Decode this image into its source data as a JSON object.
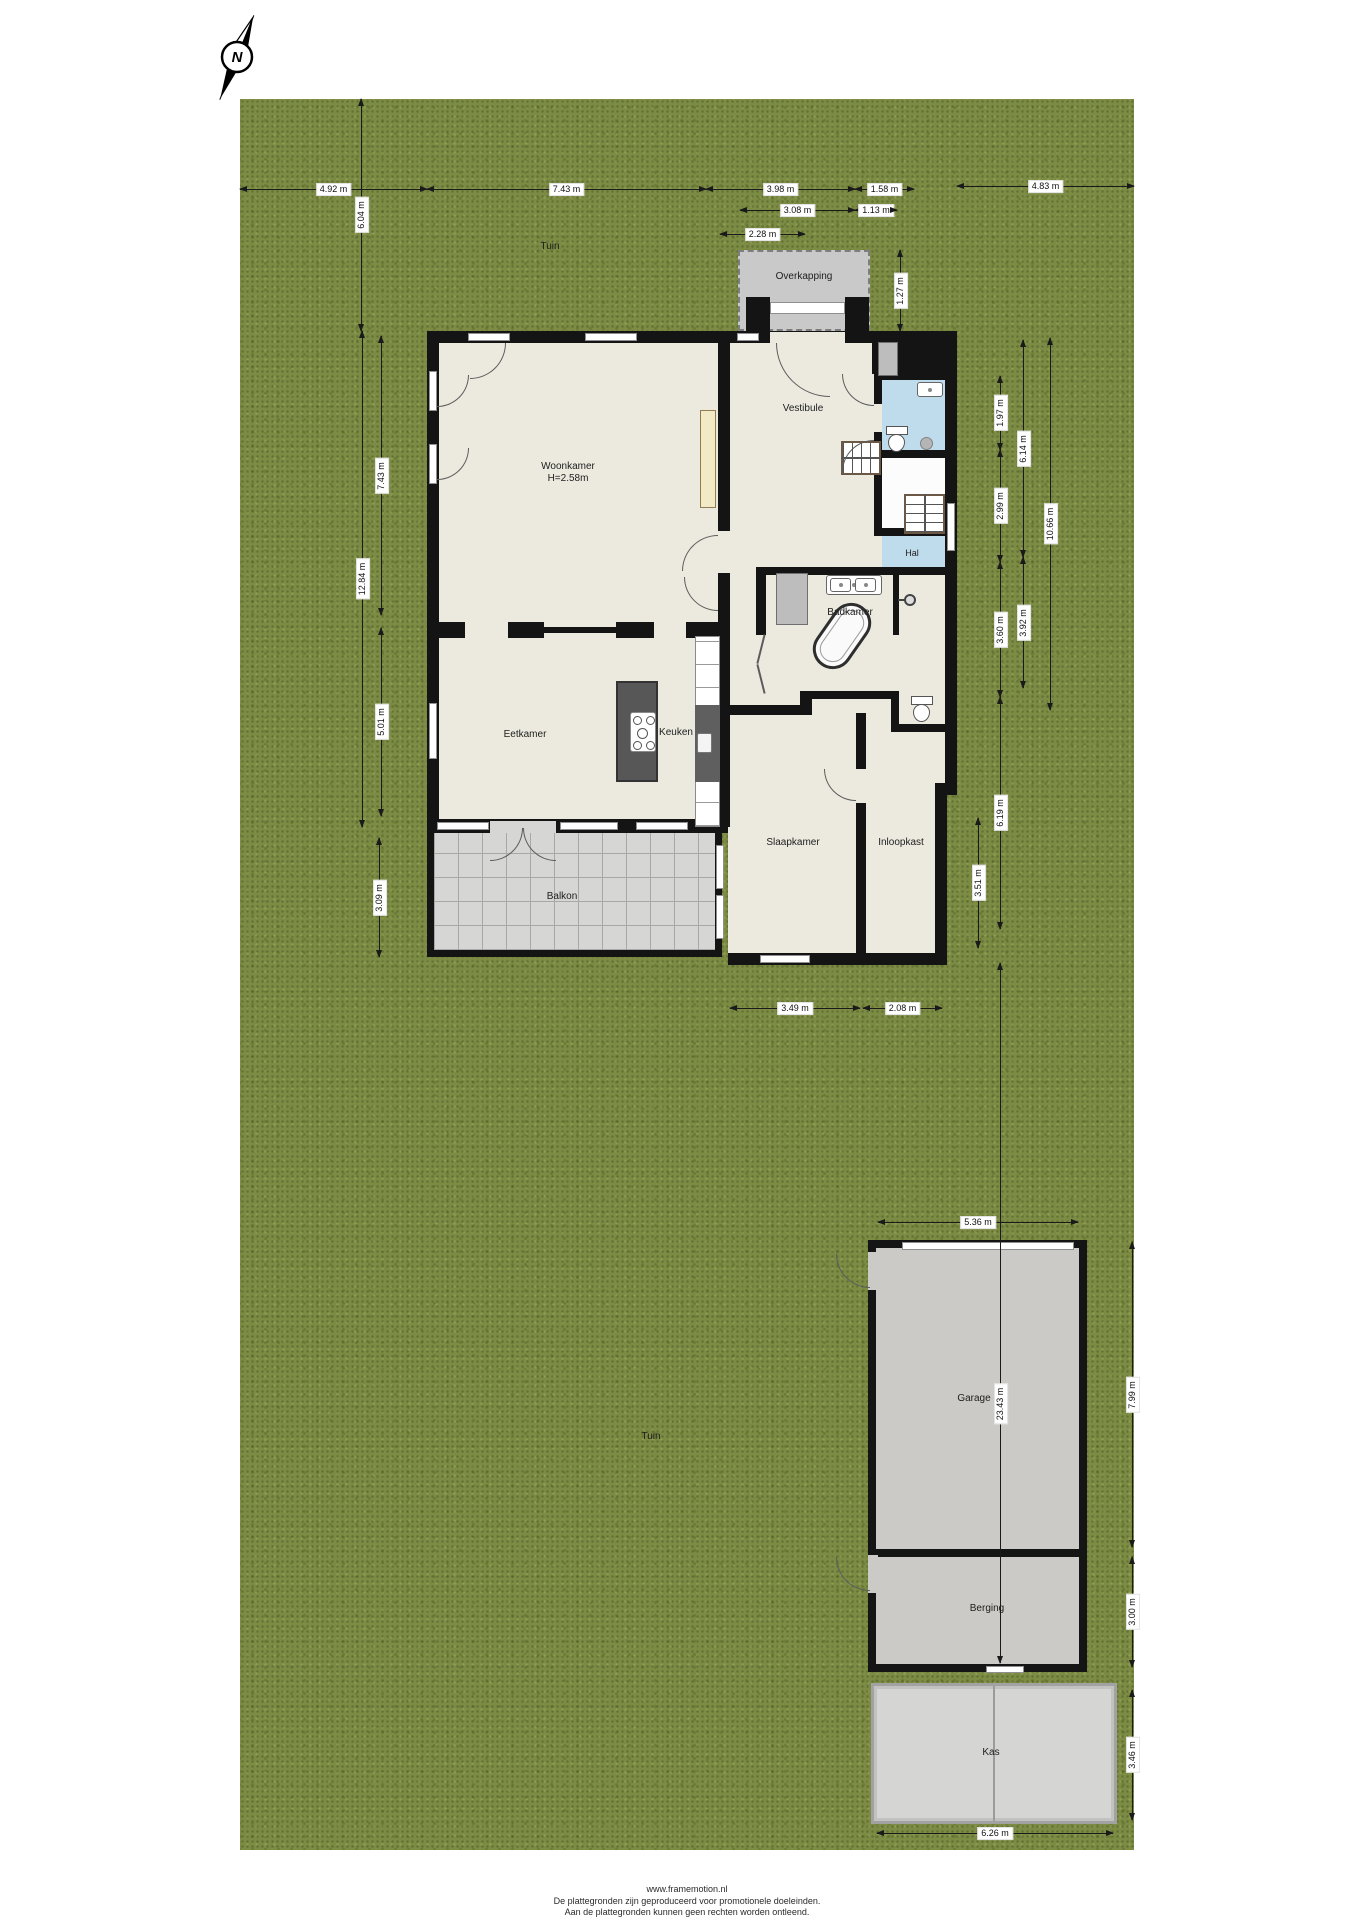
{
  "compass": {
    "label": "N"
  },
  "areas": {
    "tuin": "Tuin",
    "overkapping": "Overkapping",
    "balkon": "Balkon"
  },
  "rooms": {
    "woonkamer": {
      "label": "Woonkamer",
      "height": "H=2.58m"
    },
    "vestibule": {
      "label": "Vestibule"
    },
    "hal": {
      "label": "Hal"
    },
    "badkamer": {
      "label": "Badkamer"
    },
    "eetkamer": {
      "label": "Eetkamer"
    },
    "keuken": {
      "label": "Keuken"
    },
    "slaapkamer": {
      "label": "Slaapkamer"
    },
    "inloopkast": {
      "label": "Inloopkast"
    }
  },
  "outbuildings": {
    "garage": {
      "label": "Garage"
    },
    "berging": {
      "label": "Berging"
    },
    "kas": {
      "label": "Kas"
    }
  },
  "dimensions": [
    {
      "label": "4.92 m",
      "o": "h",
      "x": 240,
      "y": 189,
      "len": 187
    },
    {
      "label": "7.43 m",
      "o": "h",
      "x": 427,
      "y": 189,
      "len": 279
    },
    {
      "label": "3.98 m",
      "o": "h",
      "x": 706,
      "y": 189,
      "len": 149
    },
    {
      "label": "1.58 m",
      "o": "h",
      "x": 855,
      "y": 189,
      "len": 59
    },
    {
      "label": "4.83 m",
      "o": "h",
      "x": 957,
      "y": 186,
      "len": 177
    },
    {
      "label": "3.08 m",
      "o": "h",
      "x": 740,
      "y": 210,
      "len": 115
    },
    {
      "label": "1.13 m",
      "o": "h",
      "x": 855,
      "y": 210,
      "len": 42
    },
    {
      "label": "2.28 m",
      "o": "h",
      "x": 720,
      "y": 234,
      "len": 85
    },
    {
      "label": "3.49 m",
      "o": "h",
      "x": 730,
      "y": 1008,
      "len": 130
    },
    {
      "label": "2.08 m",
      "o": "h",
      "x": 863,
      "y": 1008,
      "len": 79
    },
    {
      "label": "5.36 m",
      "o": "h",
      "x": 878,
      "y": 1222,
      "len": 200
    },
    {
      "label": "6.26 m",
      "o": "h",
      "x": 877,
      "y": 1833,
      "len": 236
    },
    {
      "label": "6.04 m",
      "o": "v",
      "x": 361,
      "y": 99,
      "len": 232
    },
    {
      "label": "7.43 m",
      "o": "v",
      "x": 381,
      "y": 336,
      "len": 279
    },
    {
      "label": "5.01 m",
      "o": "v",
      "x": 381,
      "y": 628,
      "len": 188
    },
    {
      "label": "12.84 m",
      "o": "v",
      "x": 362,
      "y": 331,
      "len": 496
    },
    {
      "label": "3.09 m",
      "o": "v",
      "x": 379,
      "y": 838,
      "len": 119
    },
    {
      "label": "1.27 m",
      "o": "v",
      "x": 900,
      "y": 250,
      "len": 81
    },
    {
      "label": "1.97 m",
      "o": "v",
      "x": 1000,
      "y": 376,
      "len": 74
    },
    {
      "label": "2.99 m",
      "o": "v",
      "x": 1000,
      "y": 450,
      "len": 112
    },
    {
      "label": "3.60 m",
      "o": "v",
      "x": 1000,
      "y": 562,
      "len": 135
    },
    {
      "label": "6.19 m",
      "o": "v",
      "x": 1000,
      "y": 697,
      "len": 232
    },
    {
      "label": "6.14 m",
      "o": "v",
      "x": 1023,
      "y": 340,
      "len": 217
    },
    {
      "label": "3.92 m",
      "o": "v",
      "x": 1023,
      "y": 557,
      "len": 131
    },
    {
      "label": "10.66 m",
      "o": "v",
      "x": 1050,
      "y": 338,
      "len": 372
    },
    {
      "label": "3.51 m",
      "o": "v",
      "x": 978,
      "y": 818,
      "len": 130
    },
    {
      "label": "23.43 m",
      "o": "v",
      "x": 1000,
      "y": 963,
      "len": 700,
      "lp": 0.63
    },
    {
      "label": "7.99 m",
      "o": "v",
      "x": 1132,
      "y": 1242,
      "len": 305
    },
    {
      "label": "3.00 m",
      "o": "v",
      "x": 1132,
      "y": 1557,
      "len": 110
    },
    {
      "label": "3.46 m",
      "o": "v",
      "x": 1132,
      "y": 1690,
      "len": 130
    }
  ],
  "footer": {
    "line1": "www.framemotion.nl",
    "line2": "De plattegronden zijn geproduceerd voor promotionele doeleinden.",
    "line3": "Aan de plattegronden kunnen geen rechten worden ontleend."
  },
  "colors": {
    "garden": "#7c8c44",
    "floor": "#eceadf",
    "wall": "#141414",
    "wet_room_blue": "#bfdcec",
    "paving_gray": "#cbcac6"
  }
}
